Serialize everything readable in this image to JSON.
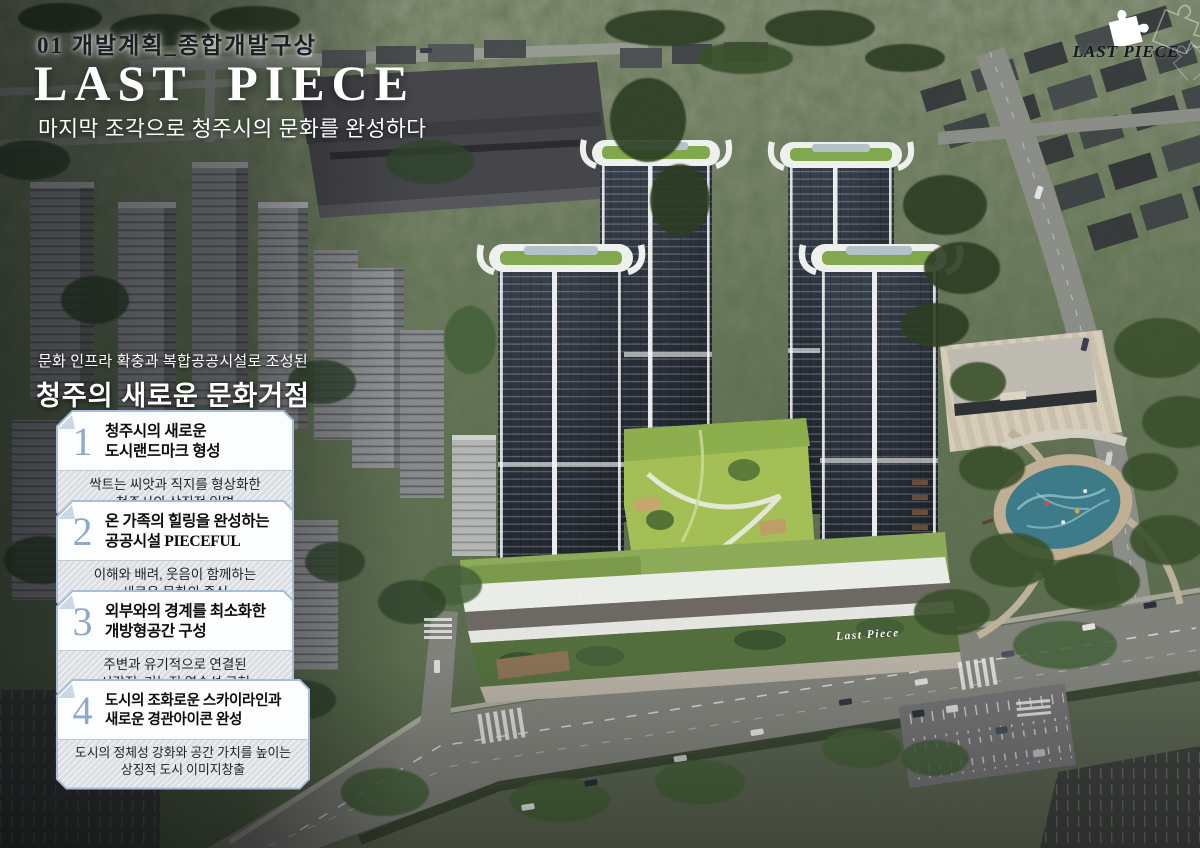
{
  "slide": {
    "kicker": "01 개발계획_종합개발구상",
    "title": "LAST PIECE",
    "subtitle": "마지막 조각으로 청주시의 문화를 완성하다"
  },
  "logo": {
    "icon": "puzzle-piece-icon",
    "label": "LAST PIECE"
  },
  "section": {
    "intro": "문화 인프라 확충과 복합공공시설로 조성된",
    "heading": "청주의 새로운 문화거점"
  },
  "points": [
    {
      "num": "1",
      "title1": "청주시의 새로운",
      "title2": "도시랜드마크 형성",
      "desc1": "싹트는 씨앗과 직지를 형상화한",
      "desc2": "청주시의 상징적 입면"
    },
    {
      "num": "2",
      "title1": "온 가족의 힐링을 완성하는",
      "title2": "공공시설 PIECEFUL",
      "desc1": "이해와 배려, 웃음이 함께하는",
      "desc2": "새로운 문화의 중심"
    },
    {
      "num": "3",
      "title1": "외부와의 경계를 최소화한",
      "title2": "개방형공간 구성",
      "desc1": "주변과 유기적으로 연결된",
      "desc2": "시각적, 기능적 연속성 구현"
    },
    {
      "num": "4",
      "title1": "도시의 조화로운 스카이라인과",
      "title2": "새로운 경관아이콘 완성",
      "desc1": "도시의 정체성 강화와 공간 가치를 높이는",
      "desc2": "상징적 도시 이미지창출"
    }
  ],
  "rendering": {
    "signage": "Last Piece"
  },
  "colors": {
    "accent_number": "#8da8c8",
    "card_border": "#a8bdd7",
    "headline_text": "#ffffff",
    "courtyard_green": "#a6c257",
    "tower_facade": "#232932"
  }
}
